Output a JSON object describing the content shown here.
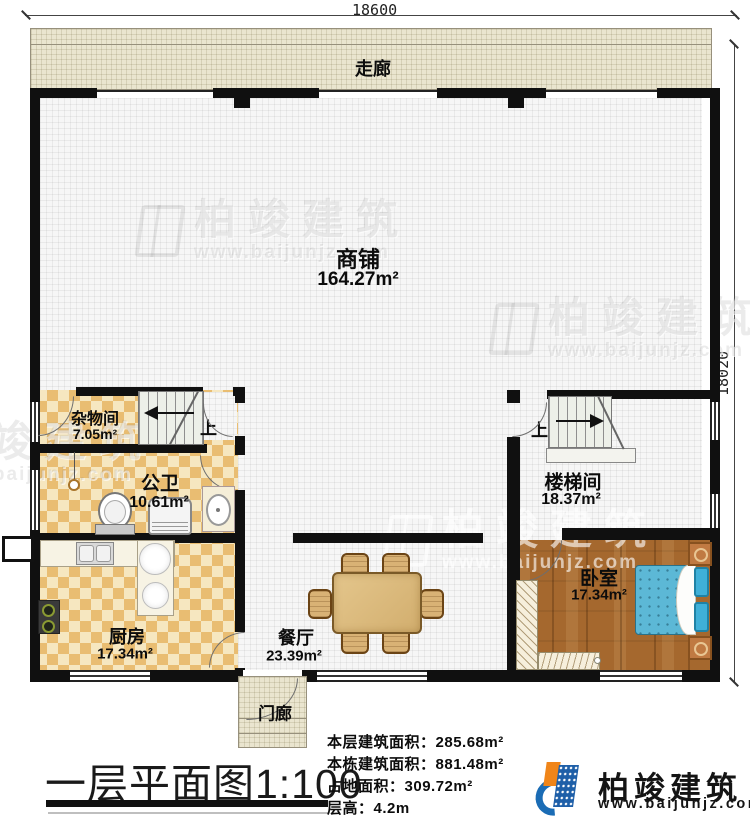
{
  "dimensions": {
    "top": "18600",
    "right": "18020"
  },
  "rooms": {
    "corridor": {
      "name": "走廊"
    },
    "shop": {
      "name": "商铺",
      "area": "164.27m²"
    },
    "storage": {
      "name": "杂物间",
      "area": "7.05m²"
    },
    "bathroom": {
      "name": "公卫",
      "area": "10.61m²"
    },
    "kitchen": {
      "name": "厨房",
      "area": "17.34m²"
    },
    "dining": {
      "name": "餐厅",
      "area": "23.39m²"
    },
    "stairwell": {
      "name": "楼梯间",
      "area": "18.37m²"
    },
    "bedroom": {
      "name": "卧室",
      "area": "17.34m²"
    },
    "porch": {
      "name": "门廊"
    }
  },
  "stairs": {
    "up_label": "上"
  },
  "title": {
    "main": "一层平面图",
    "scale": "1:100"
  },
  "info_lines": [
    {
      "label": "本层建筑面积：",
      "value": "285.68m²"
    },
    {
      "label": "本栋建筑面积：",
      "value": "881.48m²"
    },
    {
      "label": "占地面积：",
      "value": "309.72m²"
    },
    {
      "label": "层高：",
      "value": "4.2m"
    }
  ],
  "brand": {
    "name": "柏竣建筑",
    "website": "www.baijunjz.com"
  },
  "colors": {
    "wall": "#101010",
    "corridor_fill": "#eae5cf",
    "tile_dark": "#e9bd72",
    "tile_light": "#f6e7c0",
    "wood_floor": "#a5682e",
    "bed_blue": "#5cb8d6",
    "logo_blue": "#1b5ea8",
    "logo_orange": "#f08519"
  }
}
